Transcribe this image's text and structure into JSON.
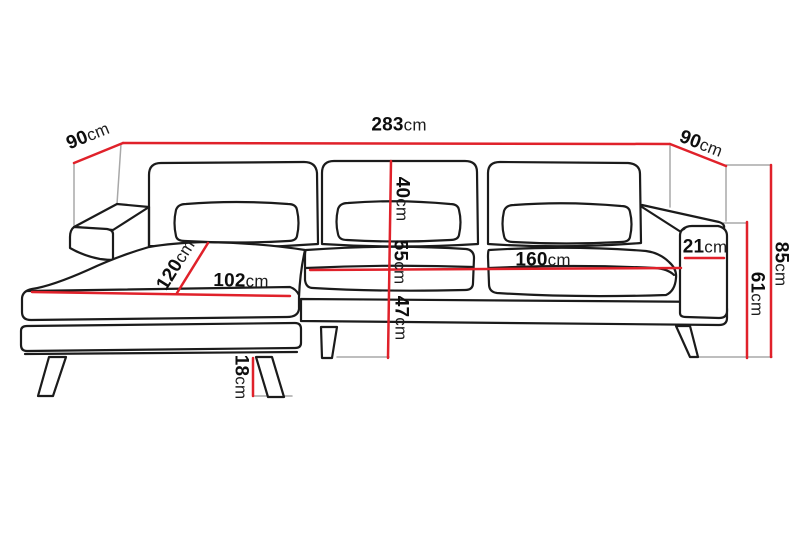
{
  "figure": {
    "kind": "corner-sofa dimension diagram",
    "view": "front three-quarter line drawing with chaise lounge on the left"
  },
  "colors": {
    "dimension_line": "#e0212a",
    "construction_line": "#a8a8a8",
    "outline": "#1b1b1b",
    "background": "#ffffff",
    "label_text": "#0e0e0e"
  },
  "dimensions": {
    "total_width": {
      "value": "283",
      "unit": "cm"
    },
    "chaise_side_depth": {
      "value": "90",
      "unit": "cm"
    },
    "right_side_depth": {
      "value": "90",
      "unit": "cm"
    },
    "backrest_cushion_height": {
      "value": "40",
      "unit": "cm"
    },
    "back_to_seat_height": {
      "value": "55",
      "unit": "cm"
    },
    "seat_front_height": {
      "value": "47",
      "unit": "cm"
    },
    "chaise_length": {
      "value": "120",
      "unit": "cm"
    },
    "chaise_width": {
      "value": "102",
      "unit": "cm"
    },
    "seat_width": {
      "value": "160",
      "unit": "cm"
    },
    "armrest_width": {
      "value": "21",
      "unit": "cm"
    },
    "armrest_height": {
      "value": "61",
      "unit": "cm"
    },
    "total_height": {
      "value": "85",
      "unit": "cm"
    },
    "leg_height": {
      "value": "18",
      "unit": "cm"
    }
  }
}
